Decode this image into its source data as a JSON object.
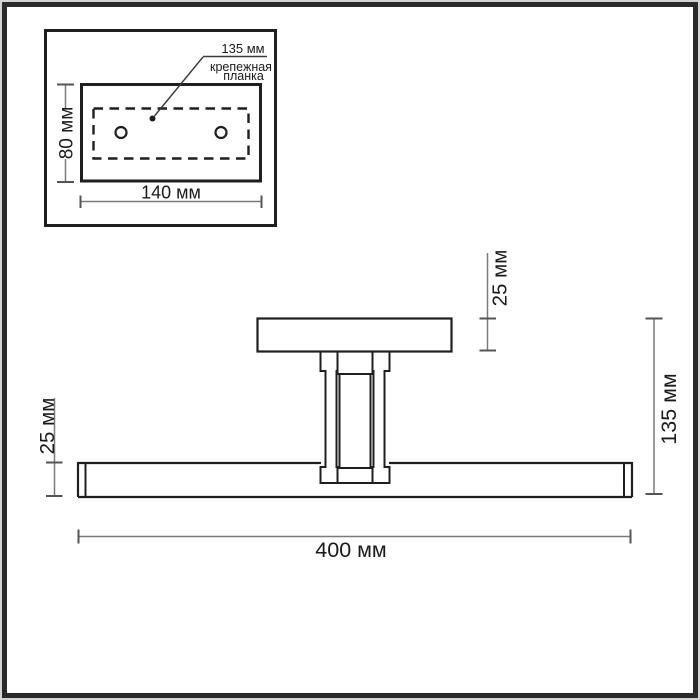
{
  "drawing": {
    "inset": {
      "hole_spacing_label": "135 мм",
      "plate_caption_line1": "крепежная",
      "plate_caption_line2": "планка",
      "height_label": "80 мм",
      "width_label": "140 мм"
    },
    "front_view": {
      "canopy_height_label": "25 мм",
      "bar_height_label": "25 мм",
      "overall_height_label": "135 мм",
      "overall_width_label": "400 мм"
    },
    "colors": {
      "outline": "#1f1f1f",
      "dimension_line": "#7a7a7a",
      "tick": "#555555",
      "label_text": "#1a1a1a",
      "frame_dark": "#2a2a2a",
      "frame_light": "#d4d4d4",
      "background": "#ffffff"
    }
  }
}
